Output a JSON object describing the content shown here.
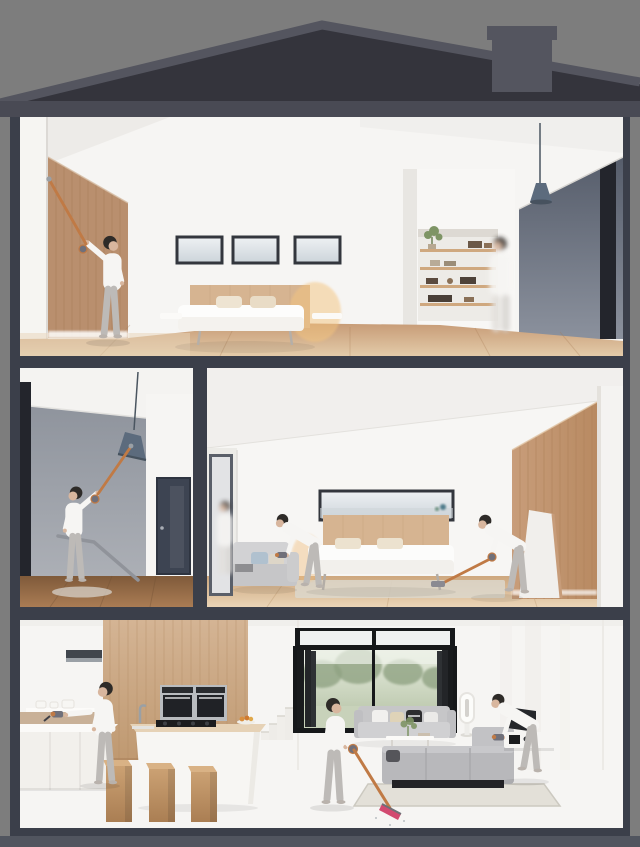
{
  "scene": {
    "description": "Cutaway cross-section of a three-storey house under a dark pitched roof with chimney; in every room a woman cleans with a cordless stick vacuum",
    "floors": [
      {
        "name": "top floor",
        "rooms": [
          {
            "name": "master bedroom",
            "objects": [
              "wood wardrobe wall",
              "three clerestory windows",
              "double bed with oak headboard and floating nightstands",
              "built-in shelf column with plant and boxes",
              "blue pendant lamp",
              "dark accent wall"
            ],
            "people": [
              "woman reaching up cleaning wardrobe top with stick vacuum",
              "blurred woman walking past shelf column"
            ]
          }
        ]
      },
      {
        "name": "middle floor",
        "rooms": [
          {
            "name": "landing",
            "objects": [
              "tilted blue pendant lamp",
              "stair handrail",
              "navy interior door",
              "dark accent strip"
            ],
            "people": [
              "woman vacuuming pendant lamp with raised stick vacuum"
            ]
          },
          {
            "name": "bedroom",
            "objects": [
              "open doorway",
              "two-seat sofa with blue cushion",
              "double bed with oak headboard",
              "panoramic ribbon window",
              "leaning panel",
              "wood wardrobe wall"
            ],
            "people": [
              "blurred woman in doorway",
              "woman vacuuming sofa with handheld vacuum",
              "woman vacuuming floor beside bed"
            ]
          }
        ]
      },
      {
        "name": "ground floor",
        "rooms": [
          {
            "name": "kitchen",
            "objects": [
              "extractor hood",
              "wood panel wall",
              "double wall ovens",
              "island with gas hob, sink and fruit bowl",
              "three wooden block stools",
              "staircase"
            ],
            "people": [
              "woman cleaning worktop with handheld vacuum"
            ]
          },
          {
            "name": "living room",
            "objects": [
              "black-framed bifold doors open to garden",
              "transom windows",
              "two grey sofas with cushions",
              "coffee table with plant",
              "area rug",
              "tower fan",
              "tv media console"
            ],
            "people": [
              "woman vacuuming floor with pink-head stick vacuum",
              "woman vacuuming sofa with handheld vacuum"
            ]
          }
        ]
      }
    ]
  },
  "colors": {
    "background": "#7d7d7d",
    "roof_fill": "#34343c",
    "roof_trim": "#54555f",
    "eave": "#494a54",
    "frame": "#3b3f4a",
    "base_bar": "#51555f",
    "wall_white": "#f6f5f3",
    "wall_gray": "#a2a6ad",
    "accent_dark": "#23252c",
    "wood_wardrobe": "#b98f6e",
    "headboard": "#d6b491",
    "sky": "#d9dfe4",
    "garden": "#b9c6ad",
    "tree": "#90a383",
    "sofa_gray": "#c0c0c3",
    "rug": "#e0dcd3",
    "lamp_blue": "#5c6b7d",
    "door_navy": "#3d4452",
    "window_frame": "#33363d",
    "bifold_frame": "#16181a",
    "vacuum_copper": "#c07a45",
    "vacuum_pink": "#d24a70",
    "vacuum_gray": "#70707a",
    "shirt": "#f6f5f3",
    "pants": "#bdbab7",
    "hair": "#2e2b28",
    "skin": "#d8b69e"
  }
}
